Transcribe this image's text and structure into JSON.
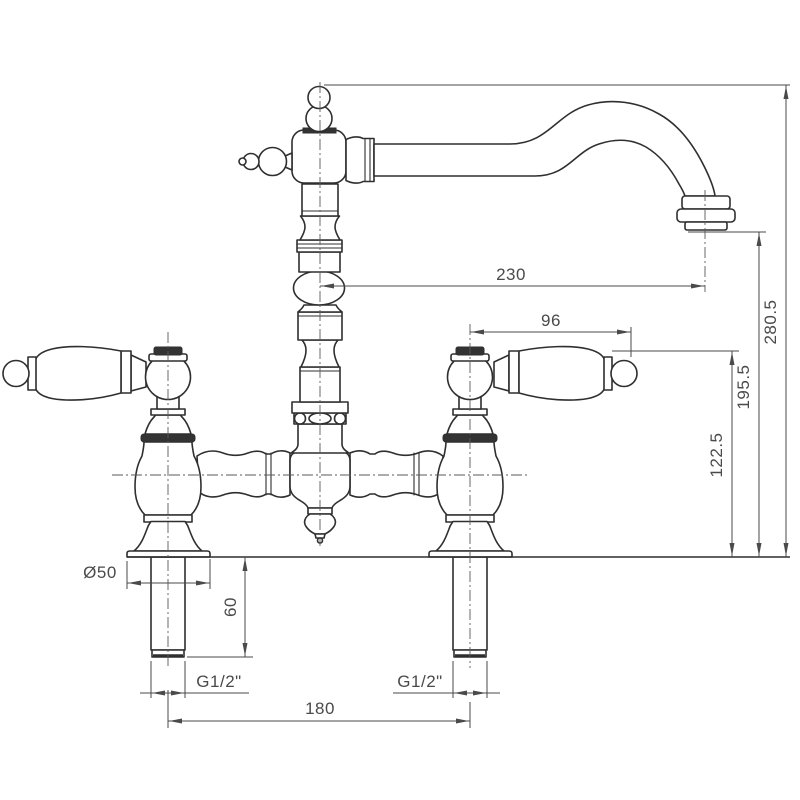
{
  "drawing": {
    "kind": "technical-drawing",
    "subject": "traditional bridge mixer tap - front elevation with dimensions",
    "colors": {
      "background": "#ffffff",
      "outline": "#2f2f2f",
      "dimension": "#4a4a4a"
    },
    "dimensions": {
      "spout_reach": "230",
      "overall_height": "280.5",
      "handle_length": "96",
      "spout_outlet_height": "195.5",
      "handle_height": "122.5",
      "base_diameter": "Ø50",
      "shank_length": "60",
      "left_thread": "G1/2\"",
      "right_thread": "G1/2\"",
      "hole_centres": "180"
    }
  }
}
